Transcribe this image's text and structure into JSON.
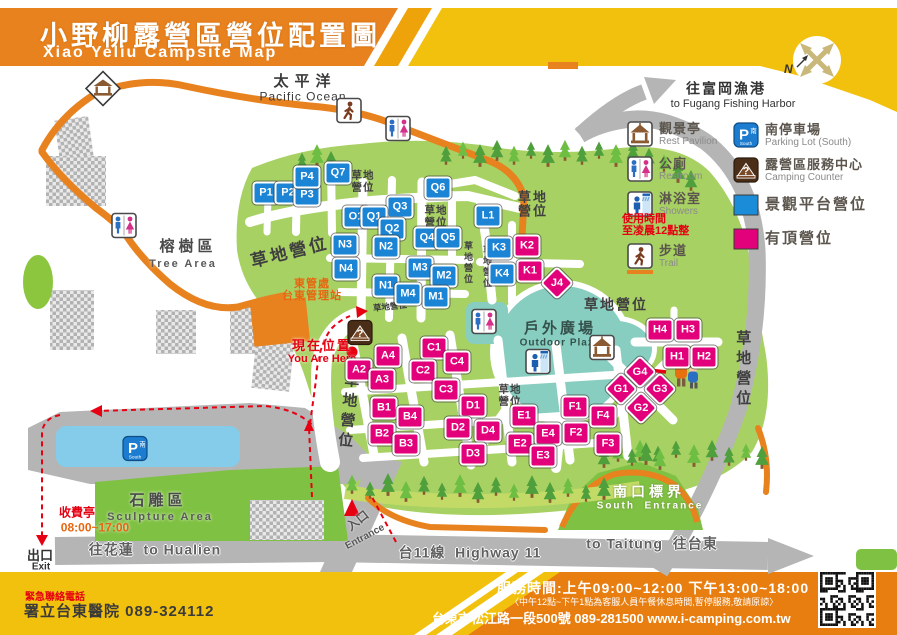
{
  "header": {
    "title_zh": "小野柳露營區營位配置圖",
    "title_en": "Xiao Yeliu Campsite Map",
    "compass_label": "N"
  },
  "colors": {
    "banner_orange": "#e8821e",
    "banner_yellow": "#f2c10e",
    "footer_orange": "#e87e10",
    "grass_green": "#a8d164",
    "tree_green": "#4fa03c",
    "plaza_teal": "#87cec1",
    "road_gray": "#b5b5b6",
    "platform_site_blue": "#1b84d4",
    "covered_site_pink": "#e3007b",
    "parking_blue": "#85cbea",
    "sculpture_green": "#7fc142",
    "alert_red": "#e60012"
  },
  "map": {
    "labels": [
      {
        "text": "太平洋",
        "x": 305,
        "y": 82,
        "k": "sea-zh"
      },
      {
        "text": "Pacific Ocean",
        "x": 303,
        "y": 97,
        "k": "sea-en"
      },
      {
        "text": "往富岡漁港",
        "x": 726,
        "y": 89,
        "k": "dest-zh"
      },
      {
        "text": "to Fugang Fishing Harbor",
        "x": 733,
        "y": 104,
        "k": "dest-en"
      },
      {
        "text": "榕樹區",
        "x": 188,
        "y": 247,
        "k": "area-zh"
      },
      {
        "text": "Tree Area",
        "x": 183,
        "y": 264,
        "k": "area-en"
      },
      {
        "text": "草地營位",
        "x": 290,
        "y": 253,
        "k": "grass-lg",
        "rot": -14
      },
      {
        "text": "草地\n營位",
        "x": 363,
        "y": 182,
        "k": "grass-sm2"
      },
      {
        "text": "草地\n營位",
        "x": 436,
        "y": 217,
        "k": "grass-sm2"
      },
      {
        "text": "草地\n營位",
        "x": 533,
        "y": 205,
        "k": "grass-md2"
      },
      {
        "text": "草地營位",
        "x": 467,
        "y": 263,
        "k": "grass-vs"
      },
      {
        "text": "草地營位",
        "x": 486,
        "y": 267,
        "k": "grass-vs"
      },
      {
        "text": "草地營位",
        "x": 390,
        "y": 307,
        "k": "grass-tiny",
        "rot": -6
      },
      {
        "text": "草地營位",
        "x": 616,
        "y": 305,
        "k": "grass-md"
      },
      {
        "text": "草地營位",
        "x": 742,
        "y": 370,
        "k": "grass-vl"
      },
      {
        "text": "草地營位",
        "x": 347,
        "y": 412,
        "k": "grass-vl",
        "rot": 6
      },
      {
        "text": "草地\n營位",
        "x": 510,
        "y": 396,
        "k": "grass-sm2"
      },
      {
        "text": "戶外廣場",
        "x": 560,
        "y": 329,
        "k": "plaza-zh"
      },
      {
        "text": "Outdoor Plaza",
        "x": 560,
        "y": 343,
        "k": "plaza-en"
      },
      {
        "text": "東管處\n台東管理站",
        "x": 312,
        "y": 290,
        "k": "hq"
      },
      {
        "text": "現在位置",
        "x": 322,
        "y": 346,
        "k": "here-zh"
      },
      {
        "text": "You Are Here",
        "x": 322,
        "y": 359,
        "k": "here-en"
      },
      {
        "text": "石雕區",
        "x": 158,
        "y": 501,
        "k": "area-zh"
      },
      {
        "text": "Sculpture Area",
        "x": 160,
        "y": 517,
        "k": "area-en"
      },
      {
        "text": "收費亭",
        "x": 77,
        "y": 513,
        "k": "toll-zh"
      },
      {
        "text": "08:00~17:00",
        "x": 95,
        "y": 528,
        "k": "toll-hours"
      },
      {
        "text": "往花蓮  to Hualien",
        "x": 155,
        "y": 550,
        "k": "road"
      },
      {
        "text": "出口",
        "x": 40,
        "y": 556,
        "k": "exit-zh"
      },
      {
        "text": "Exit",
        "x": 41,
        "y": 567,
        "k": "exit-en"
      },
      {
        "text": "入口",
        "x": 358,
        "y": 521,
        "k": "ent-zh",
        "rot": -38
      },
      {
        "text": "Entrance",
        "x": 365,
        "y": 537,
        "k": "ent-en",
        "rot": -28
      },
      {
        "text": "台11線  Highway 11",
        "x": 470,
        "y": 553,
        "k": "road"
      },
      {
        "text": "to Taitung  往台東",
        "x": 652,
        "y": 544,
        "k": "road"
      },
      {
        "text": "南口標界",
        "x": 649,
        "y": 492,
        "k": "south-zh"
      },
      {
        "text": "South  Entrance",
        "x": 650,
        "y": 506,
        "k": "south-en"
      }
    ],
    "markers": [
      {
        "code": "P1",
        "x": 266,
        "y": 193,
        "type": "blue"
      },
      {
        "code": "P2",
        "x": 288,
        "y": 193,
        "type": "blue"
      },
      {
        "code": "P3",
        "x": 307,
        "y": 195,
        "type": "blue"
      },
      {
        "code": "P4",
        "x": 307,
        "y": 177,
        "type": "blue"
      },
      {
        "code": "Q7",
        "x": 338,
        "y": 173,
        "type": "blue"
      },
      {
        "code": "Q6",
        "x": 438,
        "y": 188,
        "type": "blue"
      },
      {
        "code": "Q3",
        "x": 400,
        "y": 207,
        "type": "blue"
      },
      {
        "code": "O1",
        "x": 356,
        "y": 217,
        "type": "blue"
      },
      {
        "code": "Q1",
        "x": 374,
        "y": 217,
        "type": "blue"
      },
      {
        "code": "Q2",
        "x": 392,
        "y": 229,
        "type": "blue"
      },
      {
        "code": "Q4",
        "x": 427,
        "y": 238,
        "type": "blue"
      },
      {
        "code": "Q5",
        "x": 448,
        "y": 238,
        "type": "blue"
      },
      {
        "code": "N3",
        "x": 345,
        "y": 245,
        "type": "blue"
      },
      {
        "code": "N2",
        "x": 386,
        "y": 247,
        "type": "blue"
      },
      {
        "code": "N4",
        "x": 346,
        "y": 269,
        "type": "blue"
      },
      {
        "code": "N1",
        "x": 386,
        "y": 286,
        "type": "blue"
      },
      {
        "code": "M3",
        "x": 420,
        "y": 268,
        "type": "blue"
      },
      {
        "code": "M2",
        "x": 444,
        "y": 276,
        "type": "blue"
      },
      {
        "code": "M4",
        "x": 408,
        "y": 294,
        "type": "blue"
      },
      {
        "code": "M1",
        "x": 436,
        "y": 297,
        "type": "blue"
      },
      {
        "code": "L1",
        "x": 488,
        "y": 216,
        "type": "blue"
      },
      {
        "code": "K3",
        "x": 499,
        "y": 248,
        "type": "blue"
      },
      {
        "code": "K4",
        "x": 502,
        "y": 274,
        "type": "blue"
      },
      {
        "code": "K2",
        "x": 527,
        "y": 246,
        "type": "pink"
      },
      {
        "code": "K1",
        "x": 530,
        "y": 271,
        "type": "pink"
      },
      {
        "code": "J4",
        "x": 557,
        "y": 283,
        "type": "pinkD"
      },
      {
        "code": "A4",
        "x": 388,
        "y": 356,
        "type": "pink"
      },
      {
        "code": "A2",
        "x": 359,
        "y": 370,
        "type": "pink"
      },
      {
        "code": "A3",
        "x": 382,
        "y": 380,
        "type": "pink"
      },
      {
        "code": "B1",
        "x": 384,
        "y": 408,
        "type": "pink"
      },
      {
        "code": "B4",
        "x": 410,
        "y": 417,
        "type": "pink"
      },
      {
        "code": "B2",
        "x": 382,
        "y": 434,
        "type": "pink"
      },
      {
        "code": "B3",
        "x": 406,
        "y": 444,
        "type": "pink"
      },
      {
        "code": "C1",
        "x": 434,
        "y": 348,
        "type": "pink"
      },
      {
        "code": "C4",
        "x": 457,
        "y": 362,
        "type": "pink"
      },
      {
        "code": "C2",
        "x": 423,
        "y": 371,
        "type": "pink"
      },
      {
        "code": "C3",
        "x": 446,
        "y": 390,
        "type": "pink"
      },
      {
        "code": "D1",
        "x": 473,
        "y": 406,
        "type": "pink"
      },
      {
        "code": "D2",
        "x": 458,
        "y": 428,
        "type": "pink"
      },
      {
        "code": "D4",
        "x": 488,
        "y": 431,
        "type": "pink"
      },
      {
        "code": "D3",
        "x": 473,
        "y": 454,
        "type": "pink"
      },
      {
        "code": "E1",
        "x": 524,
        "y": 416,
        "type": "pink"
      },
      {
        "code": "E4",
        "x": 548,
        "y": 434,
        "type": "pink"
      },
      {
        "code": "E2",
        "x": 520,
        "y": 444,
        "type": "pink"
      },
      {
        "code": "E3",
        "x": 543,
        "y": 456,
        "type": "pink"
      },
      {
        "code": "F1",
        "x": 575,
        "y": 407,
        "type": "pink"
      },
      {
        "code": "F2",
        "x": 576,
        "y": 433,
        "type": "pink"
      },
      {
        "code": "F4",
        "x": 603,
        "y": 416,
        "type": "pink"
      },
      {
        "code": "F3",
        "x": 608,
        "y": 444,
        "type": "pink"
      },
      {
        "code": "H4",
        "x": 660,
        "y": 330,
        "type": "pink"
      },
      {
        "code": "H3",
        "x": 688,
        "y": 330,
        "type": "pink"
      },
      {
        "code": "H1",
        "x": 677,
        "y": 357,
        "type": "pink"
      },
      {
        "code": "H2",
        "x": 704,
        "y": 357,
        "type": "pink"
      },
      {
        "code": "G4",
        "x": 640,
        "y": 372,
        "type": "pinkD"
      },
      {
        "code": "G1",
        "x": 621,
        "y": 389,
        "type": "pinkD"
      },
      {
        "code": "G3",
        "x": 660,
        "y": 389,
        "type": "pinkD"
      },
      {
        "code": "G2",
        "x": 641,
        "y": 408,
        "type": "pinkD"
      }
    ],
    "icons": [
      {
        "name": "pavilion-sign-icon",
        "x": 103,
        "y": 91
      },
      {
        "name": "trail-icon",
        "x": 349,
        "y": 113
      },
      {
        "name": "restroom-icon",
        "x": 398,
        "y": 131
      },
      {
        "name": "restroom-icon",
        "x": 124,
        "y": 228
      },
      {
        "name": "restroom-icon",
        "x": 484,
        "y": 324
      },
      {
        "name": "shower-icon",
        "x": 538,
        "y": 364
      },
      {
        "name": "pavilion-icon",
        "x": 602,
        "y": 350
      },
      {
        "name": "counter-icon",
        "x": 360,
        "y": 335
      },
      {
        "name": "parking-icon",
        "x": 135,
        "y": 451
      },
      {
        "name": "kids-illustration",
        "x": 686,
        "y": 376
      }
    ],
    "trees": [
      [
        302,
        160
      ],
      [
        317,
        154
      ],
      [
        331,
        160
      ],
      [
        446,
        154
      ],
      [
        463,
        149
      ],
      [
        480,
        154
      ],
      [
        497,
        149
      ],
      [
        514,
        154
      ],
      [
        531,
        149
      ],
      [
        548,
        154
      ],
      [
        565,
        149
      ],
      [
        582,
        154
      ],
      [
        599,
        149
      ],
      [
        616,
        154
      ],
      [
        633,
        150
      ],
      [
        649,
        156
      ],
      [
        664,
        162
      ],
      [
        678,
        170
      ],
      [
        691,
        179
      ],
      [
        352,
        483
      ],
      [
        370,
        489
      ],
      [
        388,
        483
      ],
      [
        406,
        490
      ],
      [
        424,
        484
      ],
      [
        442,
        490
      ],
      [
        460,
        484
      ],
      [
        478,
        491
      ],
      [
        496,
        485
      ],
      [
        514,
        491
      ],
      [
        532,
        485
      ],
      [
        550,
        491
      ],
      [
        568,
        486
      ],
      [
        586,
        492
      ],
      [
        604,
        487
      ],
      [
        640,
        449
      ],
      [
        658,
        454
      ],
      [
        676,
        448
      ],
      [
        694,
        454
      ],
      [
        712,
        449
      ],
      [
        729,
        455
      ],
      [
        746,
        451
      ],
      [
        762,
        456
      ],
      [
        604,
        456
      ],
      [
        618,
        451
      ],
      [
        632,
        456
      ],
      [
        646,
        452
      ],
      [
        660,
        458
      ]
    ]
  },
  "legend": {
    "items": [
      {
        "col": 1,
        "y": 121,
        "icon": "pavilion-icon",
        "zh": "觀景亭",
        "en": "Rest Pavilion"
      },
      {
        "col": 1,
        "y": 156,
        "icon": "restroom-icon",
        "zh": "公廁",
        "en": "Restroom"
      },
      {
        "col": 1,
        "y": 191,
        "icon": "shower-icon",
        "zh": "淋浴室",
        "en": "Showers",
        "note": "使用時間\n至凌晨12點整"
      },
      {
        "col": 1,
        "y": 243,
        "icon": "trail-icon",
        "zh": "步道",
        "en": "Trail",
        "underline": true
      },
      {
        "col": 2,
        "y": 122,
        "icon": "parking-icon",
        "zh": "南停車場",
        "en": "Parking Lot (South)"
      },
      {
        "col": 2,
        "y": 157,
        "icon": "counter-icon",
        "zh": "露營區服務中心",
        "en": "Camping Counter"
      },
      {
        "col": 2,
        "y": 194,
        "icon": "blue-site-swatch",
        "zh": "景觀平台營位",
        "en": "",
        "big": true
      },
      {
        "col": 2,
        "y": 228,
        "icon": "pink-site-swatch",
        "zh": "有頂營位",
        "en": "",
        "big": true
      }
    ]
  },
  "footer": {
    "emergency_label": "緊急聯絡電話",
    "hospital": "署立台東醫院  089-324112",
    "hours": "服務時間:上午09:00~12:00  下午13:00~18:00",
    "note": "〈中午12點~下午1點為客服人員午餐休息時間,暫停服務,敬請原諒〉",
    "address": "台東市松江路一段500號  089-281500  www.i-camping.com.tw"
  }
}
